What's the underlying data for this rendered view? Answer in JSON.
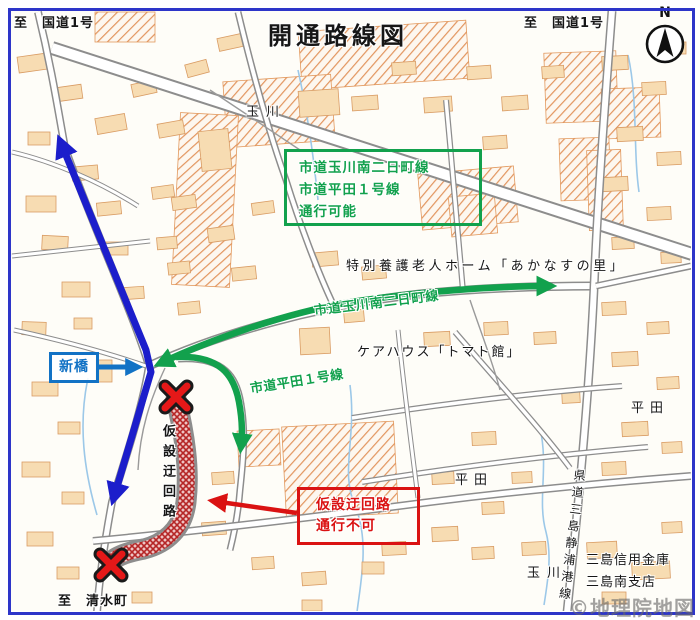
{
  "title": "開通路線図",
  "compass": {
    "north_label": "N"
  },
  "edge_labels": {
    "to_route1_left": "至　国道1号",
    "to_route1_right": "至　国道1号",
    "to_shimizucho": "至　清水町"
  },
  "legend_box": {
    "line1": "市道玉川南二日町線",
    "line2": "市道平田１号線",
    "line3": "通行可能"
  },
  "route_labels": {
    "tamagawa_futsukamachi_line": "市道玉川南二日町線",
    "hirata_line1": "市道平田１号線"
  },
  "closed_box": {
    "line1": "仮設迂回路",
    "line2": "通行不可"
  },
  "detour_label": "仮設迂回路",
  "bridge_label": "新橋",
  "landmarks": {
    "nursing_home": "特別養護老人ホーム「あかなすの里」",
    "care_house": "ケアハウス「トマト館」",
    "bank_line1": "三島信用金庫",
    "bank_line2": "三島南支店"
  },
  "area_labels": {
    "tamagawa_north": "玉川",
    "tamagawa_south": "玉川",
    "hirata_west": "平田",
    "hirata_east": "平田",
    "pref_route": "県道三島静浦港線"
  },
  "copyright": "©地理院地図",
  "colors": {
    "open_route_green": "#12a14d",
    "route_blue": "#1c1ecb",
    "bridge_blue": "#1272c5",
    "closed_red": "#da1212"
  }
}
